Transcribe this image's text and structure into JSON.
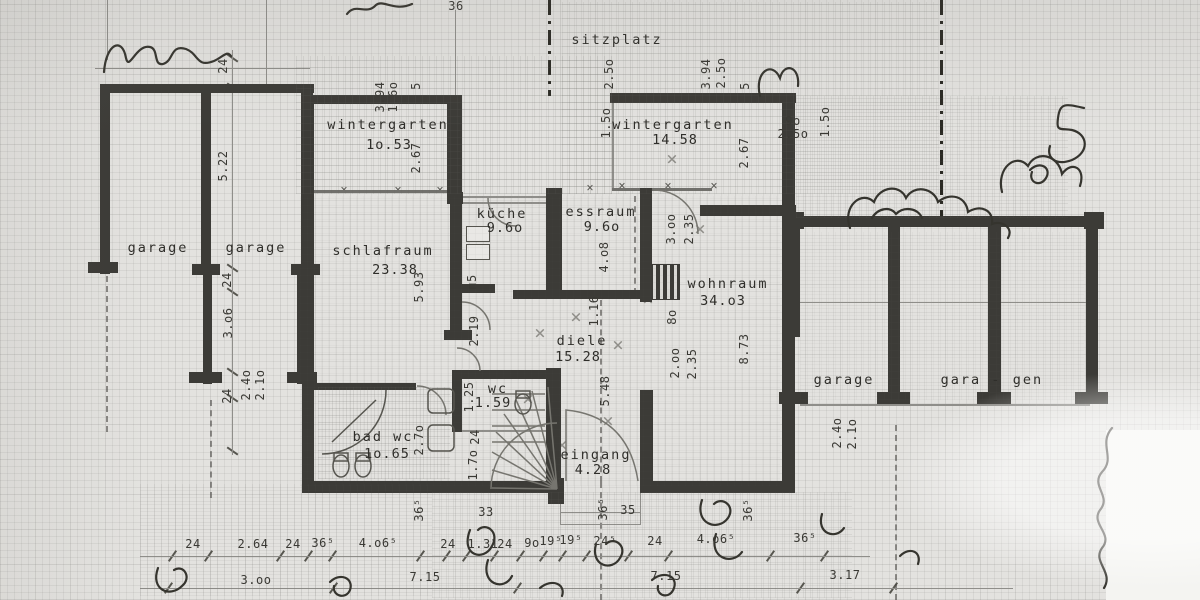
{
  "colors": {
    "paper": "#e3e2df",
    "ink": "#2f2e2a",
    "wall": "#3c3b37",
    "pencil": "#8f8e8a",
    "window_line": "#71706c",
    "grid": "#bdbcb8"
  },
  "rooms": [
    {
      "name": "sitzplatz",
      "cx": 617,
      "cy": 40
    },
    {
      "name": "wintergarten",
      "cx": 388,
      "cy": 125,
      "area": "1o.53",
      "acx": 389,
      "acy": 145
    },
    {
      "name": "wintergarten",
      "cx": 673,
      "cy": 125,
      "area": "14.58",
      "acx": 675,
      "acy": 140
    },
    {
      "name": "schlafraum",
      "cx": 383,
      "cy": 251,
      "area": "23.38",
      "acx": 395,
      "acy": 270
    },
    {
      "name": "küche",
      "cx": 502,
      "cy": 214,
      "area": "9.6o",
      "acx": 505,
      "acy": 228
    },
    {
      "name": "essraum",
      "cx": 601,
      "cy": 212,
      "area": "9.6o",
      "acx": 602,
      "acy": 227
    },
    {
      "name": "wohnraum",
      "cx": 728,
      "cy": 284,
      "area": "34.o3",
      "acx": 723,
      "acy": 301
    },
    {
      "name": "diele",
      "cx": 582,
      "cy": 341,
      "area": "15.28",
      "acx": 578,
      "acy": 357
    },
    {
      "name": "wc",
      "cx": 498,
      "cy": 389,
      "area": "1.59",
      "acx": 493,
      "acy": 403
    },
    {
      "name": "bad wc",
      "cx": 383,
      "cy": 437,
      "area": "1o.65",
      "acx": 387,
      "acy": 454
    },
    {
      "name": "eingang",
      "cx": 596,
      "cy": 455,
      "area": "4.28",
      "acx": 593,
      "acy": 470
    },
    {
      "name": "garage",
      "cx": 158,
      "cy": 248
    },
    {
      "name": "garage",
      "cx": 256,
      "cy": 248
    },
    {
      "name": "garage",
      "cx": 844,
      "cy": 380
    },
    {
      "name": "gara -",
      "cx": 971,
      "cy": 380
    },
    {
      "name": "gen",
      "cx": 1028,
      "cy": 380
    }
  ],
  "dims": {
    "h": [
      {
        "t": "36",
        "x": 456,
        "y": 6
      },
      {
        "t": "9o",
        "x": 793,
        "y": 121
      },
      {
        "t": "2.5o",
        "x": 793,
        "y": 134
      },
      {
        "t": "33",
        "x": 486,
        "y": 512
      },
      {
        "t": "35",
        "x": 628,
        "y": 510
      },
      {
        "t": "24",
        "x": 193,
        "y": 544
      },
      {
        "t": "2.64",
        "x": 253,
        "y": 544
      },
      {
        "t": "24",
        "x": 293,
        "y": 544
      },
      {
        "t": "36⁵",
        "x": 323,
        "y": 543
      },
      {
        "t": "4.o6⁵",
        "x": 378,
        "y": 543
      },
      {
        "t": "24",
        "x": 448,
        "y": 544
      },
      {
        "t": "1.31",
        "x": 483,
        "y": 544
      },
      {
        "t": "24",
        "x": 505,
        "y": 544
      },
      {
        "t": "9o",
        "x": 532,
        "y": 543
      },
      {
        "t": "19⁵",
        "x": 551,
        "y": 541
      },
      {
        "t": "19⁵",
        "x": 571,
        "y": 540
      },
      {
        "t": "24⁵",
        "x": 605,
        "y": 541
      },
      {
        "t": "24",
        "x": 655,
        "y": 541
      },
      {
        "t": "4.o6⁵",
        "x": 716,
        "y": 539
      },
      {
        "t": "36⁵",
        "x": 805,
        "y": 538
      },
      {
        "t": "3.oo",
        "x": 256,
        "y": 580
      },
      {
        "t": "7.15",
        "x": 425,
        "y": 577
      },
      {
        "t": "7.15",
        "x": 666,
        "y": 576
      },
      {
        "t": "3.17",
        "x": 845,
        "y": 575
      }
    ],
    "v": [
      {
        "t": "24",
        "x": 223,
        "y": 66
      },
      {
        "t": "5.22",
        "x": 223,
        "y": 166
      },
      {
        "t": "24",
        "x": 227,
        "y": 280
      },
      {
        "t": "3.o6",
        "x": 228,
        "y": 323
      },
      {
        "t": "24",
        "x": 227,
        "y": 396
      },
      {
        "t": "2.4o",
        "x": 246,
        "y": 385
      },
      {
        "t": "2.1o",
        "x": 260,
        "y": 385
      },
      {
        "t": "3.94",
        "x": 380,
        "y": 97
      },
      {
        "t": "1.6o",
        "x": 393,
        "y": 97
      },
      {
        "t": "5",
        "x": 416,
        "y": 86
      },
      {
        "t": "2.67",
        "x": 416,
        "y": 158
      },
      {
        "t": "2.5o",
        "x": 609,
        "y": 74
      },
      {
        "t": "1.5o",
        "x": 606,
        "y": 123
      },
      {
        "t": "3.94",
        "x": 706,
        "y": 74
      },
      {
        "t": "2.5o",
        "x": 721,
        "y": 73
      },
      {
        "t": "5",
        "x": 745,
        "y": 86
      },
      {
        "t": "2.67",
        "x": 744,
        "y": 153
      },
      {
        "t": "1.5o",
        "x": 825,
        "y": 122
      },
      {
        "t": "5.93",
        "x": 419,
        "y": 287
      },
      {
        "t": "2.19",
        "x": 474,
        "y": 331
      },
      {
        "t": "п5",
        "x": 472,
        "y": 282
      },
      {
        "t": "4.o8",
        "x": 604,
        "y": 257
      },
      {
        "t": "1.16",
        "x": 594,
        "y": 311
      },
      {
        "t": "8o",
        "x": 672,
        "y": 317
      },
      {
        "t": "3.oo",
        "x": 671,
        "y": 229
      },
      {
        "t": "2.35",
        "x": 689,
        "y": 229
      },
      {
        "t": "2.oo",
        "x": 675,
        "y": 363
      },
      {
        "t": "2.35",
        "x": 692,
        "y": 364
      },
      {
        "t": "8.73",
        "x": 744,
        "y": 349
      },
      {
        "t": "5.48",
        "x": 605,
        "y": 391
      },
      {
        "t": "2.7o",
        "x": 419,
        "y": 440
      },
      {
        "t": "1.25",
        "x": 469,
        "y": 397
      },
      {
        "t": "24",
        "x": 475,
        "y": 437
      },
      {
        "t": "1.7o",
        "x": 473,
        "y": 465
      },
      {
        "t": "36⁵",
        "x": 419,
        "y": 510
      },
      {
        "t": "36⁵",
        "x": 603,
        "y": 509
      },
      {
        "t": "36⁵",
        "x": 748,
        "y": 510
      },
      {
        "t": "2.4o",
        "x": 837,
        "y": 433
      },
      {
        "t": "2.1o",
        "x": 852,
        "y": 434
      }
    ]
  },
  "handwritten": {
    "corner_mark": "5"
  }
}
